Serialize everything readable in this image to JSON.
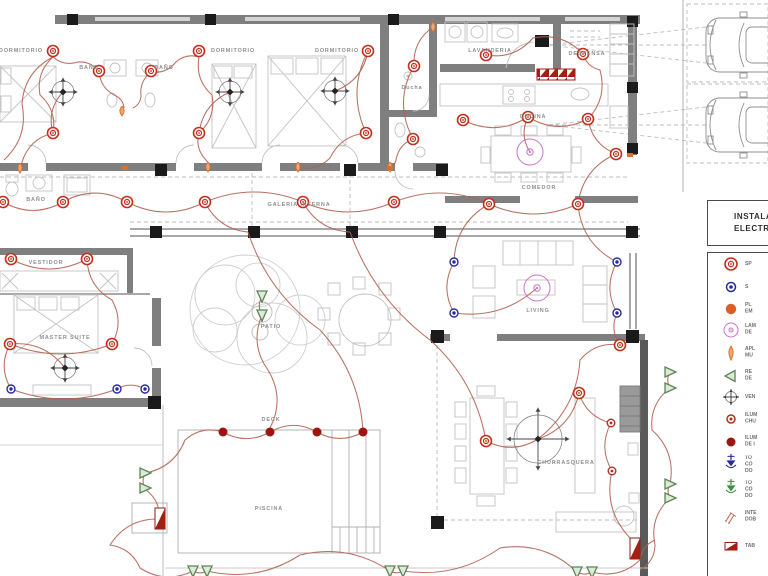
{
  "colors": {
    "wall": "#7f7f7f",
    "wire": "#b2604f",
    "spot": "#c2301c",
    "outlet": "#2a2a9e",
    "lamp": "#cc70cc",
    "socket": "#d95f28",
    "sconce": "#d8712e",
    "reflector_stroke": "#5c8456",
    "reflector_fill": "#dcead7",
    "deck_light": "#9e1510",
    "grill_light": "#b03020",
    "panel": "#a31f12",
    "toma_green": "#3f8f3f",
    "fan": "#444444"
  },
  "rooms": [
    {
      "label": "DORMITORIO",
      "x": 21,
      "y": 51
    },
    {
      "label": "BAÑO",
      "x": 89,
      "y": 68
    },
    {
      "label": "BAÑO",
      "x": 164,
      "y": 68
    },
    {
      "label": "DORMITORIO",
      "x": 233,
      "y": 51
    },
    {
      "label": "DORMITORIO",
      "x": 337,
      "y": 51
    },
    {
      "label": "Ducha",
      "x": 412,
      "y": 88
    },
    {
      "label": "LAVANDERIA",
      "x": 490,
      "y": 51
    },
    {
      "label": "DESPENSA",
      "x": 587,
      "y": 54
    },
    {
      "label": "COCINA",
      "x": 533,
      "y": 117
    },
    {
      "label": "COMEDOR",
      "x": 539,
      "y": 188
    },
    {
      "label": "BAÑO",
      "x": 36,
      "y": 200
    },
    {
      "label": "VESTIDOR",
      "x": 46,
      "y": 263
    },
    {
      "label": "MASTER SUITE",
      "x": 65,
      "y": 338
    },
    {
      "label": "GALERIA INTERNA",
      "x": 299,
      "y": 205
    },
    {
      "label": "PATIO",
      "x": 271,
      "y": 327
    },
    {
      "label": "LIVING",
      "x": 538,
      "y": 311
    },
    {
      "label": "DECK",
      "x": 271,
      "y": 420
    },
    {
      "label": "PISCINA",
      "x": 269,
      "y": 509
    },
    {
      "label": "CHURRASQUERA",
      "x": 566,
      "y": 463
    }
  ],
  "plan": {
    "symbols": {
      "spots": [
        [
          53,
          51
        ],
        [
          99,
          71
        ],
        [
          151,
          71
        ],
        [
          199,
          51
        ],
        [
          53,
          133
        ],
        [
          199,
          133
        ],
        [
          368,
          51
        ],
        [
          366,
          133
        ],
        [
          414,
          66
        ],
        [
          413,
          139
        ],
        [
          486,
          55
        ],
        [
          583,
          54
        ],
        [
          463,
          120
        ],
        [
          528,
          117
        ],
        [
          588,
          119
        ],
        [
          616,
          154
        ],
        [
          3,
          202
        ],
        [
          63,
          202
        ],
        [
          127,
          202
        ],
        [
          205,
          202
        ],
        [
          303,
          202
        ],
        [
          394,
          202
        ],
        [
          489,
          204
        ],
        [
          578,
          204
        ],
        [
          11,
          259
        ],
        [
          87,
          259
        ],
        [
          10,
          344
        ],
        [
          112,
          344
        ],
        [
          486,
          441
        ],
        [
          579,
          393
        ],
        [
          620,
          345
        ]
      ],
      "outlets": [
        [
          454,
          262
        ],
        [
          617,
          262
        ],
        [
          454,
          313
        ],
        [
          617,
          313
        ],
        [
          11,
          389
        ],
        [
          117,
          389
        ],
        [
          145,
          389
        ]
      ],
      "lamps": [
        [
          530,
          152
        ],
        [
          537,
          288
        ]
      ],
      "fans": [
        {
          "x": 63,
          "y": 92,
          "r": 11
        },
        {
          "x": 230,
          "y": 92,
          "r": 11
        },
        {
          "x": 335,
          "y": 91,
          "r": 11
        },
        {
          "x": 65,
          "y": 368,
          "r": 11
        },
        {
          "x": 538,
          "y": 439,
          "r": 24
        }
      ],
      "deck_lights": [
        [
          223,
          432
        ],
        [
          270,
          432
        ],
        [
          317,
          432
        ],
        [
          363,
          432
        ]
      ],
      "grill_lights": [
        [
          611,
          423
        ],
        [
          612,
          471
        ]
      ],
      "reflectors": [
        [
          145,
          473,
          "r"
        ],
        [
          145,
          488,
          "r"
        ],
        [
          262,
          296,
          "d"
        ],
        [
          262,
          315,
          "d"
        ],
        [
          670,
          372,
          "r"
        ],
        [
          670,
          388,
          "r"
        ],
        [
          670,
          484,
          "r"
        ],
        [
          670,
          498,
          "r"
        ],
        [
          193,
          571,
          "d"
        ],
        [
          207,
          571,
          "d"
        ],
        [
          390,
          571,
          "d"
        ],
        [
          403,
          571,
          "d"
        ],
        [
          577,
          572,
          "d"
        ],
        [
          592,
          572,
          "d"
        ]
      ],
      "sconces": [
        [
          20,
          168
        ],
        [
          122,
          111
        ],
        [
          208,
          167
        ],
        [
          298,
          167
        ],
        [
          390,
          167
        ],
        [
          433,
          27
        ]
      ],
      "level_markers": [
        [
          125,
          168
        ],
        [
          390,
          168
        ],
        [
          630,
          155
        ]
      ],
      "panels": [
        [
          155,
          508
        ],
        [
          630,
          538
        ]
      ]
    },
    "wires": [
      [
        [
          4,
          160
        ],
        [
          22,
          104
        ],
        [
          53,
          57
        ]
      ],
      [
        [
          53,
          57
        ],
        [
          78,
          62
        ],
        [
          99,
          72
        ]
      ],
      [
        [
          99,
          72
        ],
        [
          116,
          96
        ],
        [
          124,
          108
        ]
      ],
      [
        [
          151,
          72
        ],
        [
          141,
          96
        ],
        [
          133,
          108
        ]
      ],
      [
        [
          199,
          57
        ],
        [
          176,
          62
        ],
        [
          151,
          72
        ]
      ],
      [
        [
          53,
          133
        ],
        [
          40,
          95
        ],
        [
          53,
          57
        ]
      ],
      [
        [
          199,
          133
        ],
        [
          212,
          95
        ],
        [
          199,
          57
        ]
      ],
      [
        [
          53,
          133
        ],
        [
          22,
          162
        ],
        [
          20,
          168
        ]
      ],
      [
        [
          199,
          133
        ],
        [
          206,
          160
        ],
        [
          208,
          167
        ]
      ],
      [
        [
          368,
          51
        ],
        [
          366,
          133
        ]
      ],
      [
        [
          366,
          133
        ],
        [
          330,
          158
        ],
        [
          298,
          167
        ]
      ],
      [
        [
          335,
          91
        ],
        [
          368,
          51
        ]
      ],
      [
        [
          230,
          92
        ],
        [
          199,
          133
        ]
      ],
      [
        [
          63,
          92
        ],
        [
          53,
          133
        ]
      ],
      [
        [
          414,
          66
        ],
        [
          413,
          139
        ]
      ],
      [
        [
          413,
          139
        ],
        [
          396,
          160
        ],
        [
          390,
          167
        ]
      ],
      [
        [
          433,
          27
        ],
        [
          414,
          66
        ]
      ],
      [
        [
          486,
          55
        ],
        [
          533,
          38
        ],
        [
          583,
          54
        ]
      ],
      [
        [
          583,
          54
        ],
        [
          600,
          70
        ],
        [
          588,
          119
        ]
      ],
      [
        [
          463,
          120
        ],
        [
          528,
          117
        ]
      ],
      [
        [
          528,
          117
        ],
        [
          588,
          119
        ]
      ],
      [
        [
          588,
          119
        ],
        [
          616,
          154
        ]
      ],
      [
        [
          528,
          117
        ],
        [
          530,
          152
        ]
      ],
      [
        [
          616,
          154
        ],
        [
          578,
          204
        ]
      ],
      [
        [
          3,
          202
        ],
        [
          63,
          202
        ],
        [
          127,
          202
        ],
        [
          205,
          202
        ],
        [
          303,
          202
        ],
        [
          394,
          202
        ],
        [
          489,
          204
        ],
        [
          578,
          204
        ]
      ],
      [
        [
          11,
          259
        ],
        [
          87,
          259
        ]
      ],
      [
        [
          87,
          259
        ],
        [
          112,
          300
        ],
        [
          112,
          344
        ]
      ],
      [
        [
          10,
          344
        ],
        [
          112,
          344
        ]
      ],
      [
        [
          65,
          368
        ],
        [
          10,
          344
        ]
      ],
      [
        [
          10,
          344
        ],
        [
          11,
          389
        ]
      ],
      [
        [
          11,
          389
        ],
        [
          117,
          389
        ],
        [
          145,
          389
        ]
      ],
      [
        [
          489,
          204
        ],
        [
          454,
          262
        ]
      ],
      [
        [
          454,
          262
        ],
        [
          454,
          313
        ]
      ],
      [
        [
          454,
          313
        ],
        [
          537,
          288
        ]
      ],
      [
        [
          578,
          204
        ],
        [
          617,
          262
        ]
      ],
      [
        [
          617,
          262
        ],
        [
          617,
          313
        ]
      ],
      [
        [
          617,
          313
        ],
        [
          620,
          345
        ]
      ],
      [
        [
          205,
          202
        ],
        [
          248,
          232
        ]
      ],
      [
        [
          303,
          202
        ],
        [
          350,
          232
        ]
      ],
      [
        [
          248,
          232
        ],
        [
          320,
          330
        ],
        [
          363,
          432
        ]
      ],
      [
        [
          350,
          232
        ],
        [
          430,
          340
        ],
        [
          486,
          441
        ]
      ],
      [
        [
          262,
          296
        ],
        [
          262,
          315
        ]
      ],
      [
        [
          262,
          315
        ],
        [
          268,
          370
        ],
        [
          270,
          428
        ]
      ],
      [
        [
          223,
          432
        ],
        [
          270,
          432
        ],
        [
          317,
          432
        ],
        [
          363,
          432
        ]
      ],
      [
        [
          159,
          519
        ],
        [
          146,
          490
        ],
        [
          145,
          473
        ]
      ],
      [
        [
          145,
          473
        ],
        [
          185,
          440
        ],
        [
          223,
          432
        ]
      ],
      [
        [
          159,
          519
        ],
        [
          110,
          545
        ],
        [
          140,
          568
        ],
        [
          193,
          571
        ]
      ],
      [
        [
          193,
          571
        ],
        [
          207,
          571
        ]
      ],
      [
        [
          207,
          571
        ],
        [
          300,
          555
        ],
        [
          390,
          571
        ]
      ],
      [
        [
          390,
          571
        ],
        [
          403,
          571
        ]
      ],
      [
        [
          403,
          571
        ],
        [
          500,
          548
        ],
        [
          577,
          572
        ]
      ],
      [
        [
          577,
          572
        ],
        [
          592,
          572
        ]
      ],
      [
        [
          592,
          572
        ],
        [
          640,
          560
        ],
        [
          655,
          540
        ]
      ],
      [
        [
          486,
          441
        ],
        [
          538,
          439
        ]
      ],
      [
        [
          538,
          439
        ],
        [
          579,
          393
        ]
      ],
      [
        [
          579,
          393
        ],
        [
          611,
          423
        ]
      ],
      [
        [
          611,
          423
        ],
        [
          612,
          471
        ]
      ],
      [
        [
          612,
          471
        ],
        [
          632,
          540
        ]
      ],
      [
        [
          670,
          372
        ],
        [
          670,
          388
        ]
      ],
      [
        [
          670,
          388
        ],
        [
          652,
          430
        ],
        [
          670,
          484
        ]
      ],
      [
        [
          670,
          484
        ],
        [
          670,
          498
        ]
      ],
      [
        [
          670,
          498
        ],
        [
          655,
          545
        ],
        [
          640,
          570
        ]
      ],
      [
        [
          620,
          345
        ],
        [
          580,
          360
        ],
        [
          538,
          439
        ]
      ]
    ]
  },
  "legend": {
    "title_line1": "INSTALA",
    "title_line2": "ELECTR",
    "items": [
      {
        "type": "spot",
        "icon": "spot-icon",
        "y": 263,
        "lines": [
          "SP"
        ]
      },
      {
        "type": "outlet",
        "icon": "outlet-icon",
        "y": 286,
        "lines": [
          "S"
        ]
      },
      {
        "type": "socket",
        "icon": "socket-icon",
        "y": 308,
        "lines": [
          "PL",
          "EM"
        ]
      },
      {
        "type": "lamp",
        "icon": "lamp-icon",
        "y": 329,
        "lines": [
          "LAM",
          "DE"
        ]
      },
      {
        "type": "sconce",
        "icon": "sconce-icon",
        "y": 352,
        "lines": [
          "APL",
          "MU"
        ]
      },
      {
        "type": "reflector",
        "icon": "reflector-icon",
        "y": 375,
        "lines": [
          "RE",
          "DE"
        ]
      },
      {
        "type": "fan",
        "icon": "fan-icon",
        "y": 396,
        "lines": [
          "VEN"
        ]
      },
      {
        "type": "grill-light",
        "icon": "grill-light-icon",
        "y": 418,
        "lines": [
          "ILUM",
          "CHU"
        ]
      },
      {
        "type": "deck-light",
        "icon": "deck-light-icon",
        "y": 441,
        "lines": [
          "ILUM",
          "DE I"
        ]
      },
      {
        "type": "toma-blue",
        "icon": "toma-blue-icon",
        "y": 464,
        "lines": [
          "TO",
          "CO",
          "DO"
        ]
      },
      {
        "type": "toma-green",
        "icon": "toma-green-icon",
        "y": 489,
        "lines": [
          "TO",
          "CO",
          "DO"
        ]
      },
      {
        "type": "switch",
        "icon": "switch-icon",
        "y": 516,
        "lines": [
          "INTE",
          "DOB"
        ]
      },
      {
        "type": "panel",
        "icon": "panel-icon",
        "y": 545,
        "lines": [
          "TAB"
        ]
      }
    ]
  },
  "parking": {
    "spaces": 2
  }
}
